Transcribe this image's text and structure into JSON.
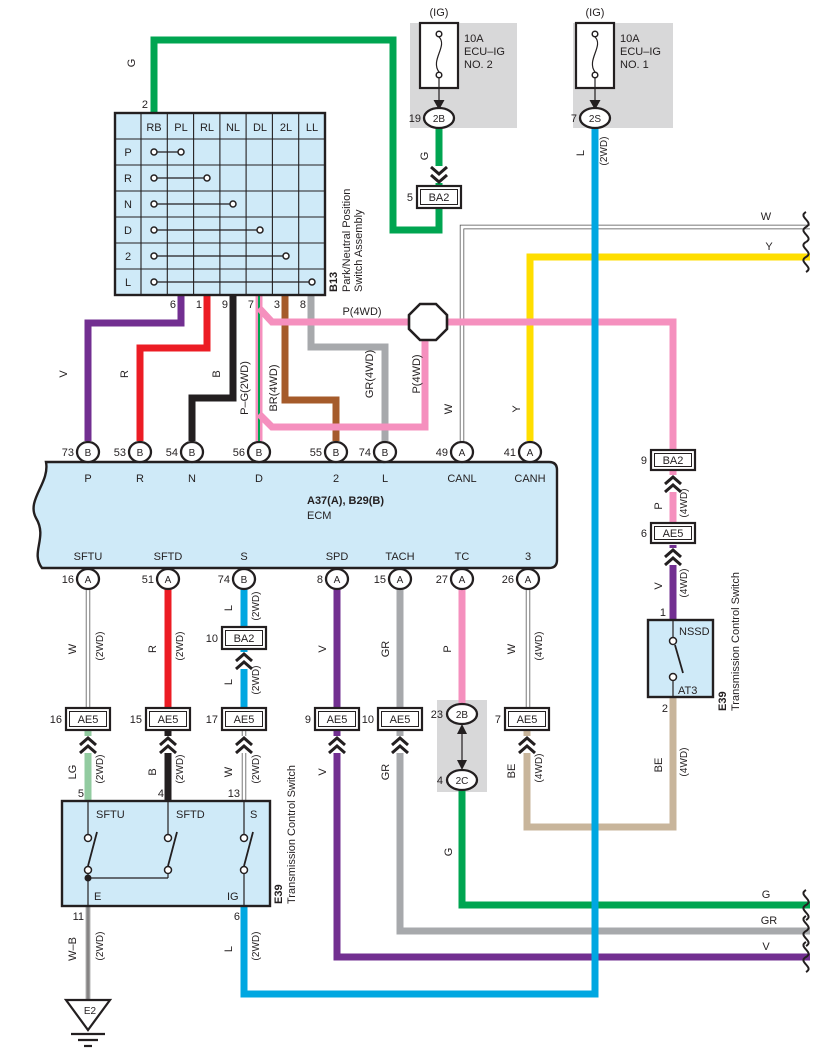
{
  "colors": {
    "green": "#00A551",
    "red": "#EC1C24",
    "black": "#231F20",
    "purple": "#722F91",
    "pink": "#F590BE",
    "brown": "#A55B2B",
    "gray": "#A7A9AC",
    "yellow": "#FFDE00",
    "cyan": "#00A7E1",
    "light_green": "#92CBA0",
    "beige": "#C8B59B",
    "component_fill": "#CFEAF8",
    "panel_gray": "#D8D8D9",
    "white_wire": "#FFFFFF"
  },
  "fuses": [
    {
      "tag": "(IG)",
      "amp": "10A",
      "name": "ECU–IG",
      "num": "NO. 2",
      "pin": "19",
      "conn": "2B"
    },
    {
      "tag": "(IG)",
      "amp": "10A",
      "name": "ECU–IG",
      "num": "NO. 1",
      "pin": "7",
      "conn": "2S"
    }
  ],
  "fuse_wires": {
    "g": "G",
    "l": "L",
    "l_sub": "(2WD)"
  },
  "pnp": {
    "code": "B13",
    "name_line1": "Park/Neutral Position",
    "name_line2": "Switch Assembly",
    "top_pin": "2",
    "top_wire": "G",
    "cols": [
      "RB",
      "PL",
      "RL",
      "NL",
      "DL",
      "2L",
      "LL"
    ],
    "rows": [
      "P",
      "R",
      "N",
      "D",
      "2",
      "L"
    ],
    "pins": [
      "6",
      "1",
      "9",
      "7",
      "3",
      "8"
    ]
  },
  "feeds": {
    "v": "V",
    "r": "R",
    "b": "B",
    "pg": "P–G(2WD)",
    "br": "BR(4WD)",
    "gr": "GR(4WD)",
    "p4h": "P(4WD)",
    "p4v": "P(4WD)",
    "w": "W",
    "y": "Y"
  },
  "ecm": {
    "code": "A37(A), B29(B)",
    "name": "ECM",
    "top": [
      {
        "n": "73",
        "c": "B",
        "l": "P"
      },
      {
        "n": "53",
        "c": "B",
        "l": "R"
      },
      {
        "n": "54",
        "c": "B",
        "l": "N"
      },
      {
        "n": "56",
        "c": "B",
        "l": "D"
      },
      {
        "n": "55",
        "c": "B",
        "l": "2"
      },
      {
        "n": "74",
        "c": "B",
        "l": "L"
      },
      {
        "n": "49",
        "c": "A",
        "l": "CANL"
      },
      {
        "n": "41",
        "c": "A",
        "l": "CANH"
      }
    ],
    "bottom": [
      {
        "n": "16",
        "c": "A",
        "l": "SFTU"
      },
      {
        "n": "51",
        "c": "A",
        "l": "SFTD"
      },
      {
        "n": "74",
        "c": "B",
        "l": "S"
      },
      {
        "n": "8",
        "c": "A",
        "l": "SPD"
      },
      {
        "n": "15",
        "c": "A",
        "l": "TACH"
      },
      {
        "n": "27",
        "c": "A",
        "l": "TC"
      },
      {
        "n": "26",
        "c": "A",
        "l": "3"
      }
    ]
  },
  "conn": {
    "ba2_top": {
      "n": "5",
      "l": "BA2"
    },
    "ba2_mid": {
      "n": "10",
      "l": "BA2"
    },
    "ba2_right": {
      "n": "9",
      "l": "BA2"
    },
    "ae5_right": {
      "n": "6",
      "l": "AE5"
    },
    "row": [
      {
        "n": "16",
        "l": "AE5"
      },
      {
        "n": "15",
        "l": "AE5"
      },
      {
        "n": "17",
        "l": "AE5"
      },
      {
        "n": "9",
        "l": "AE5"
      },
      {
        "n": "10",
        "l": "AE5"
      },
      {
        "n": "7",
        "l": "AE5"
      }
    ],
    "j2b": {
      "n": "23",
      "l": "2B"
    },
    "j2c": {
      "n": "4",
      "l": "2C"
    }
  },
  "runs": {
    "sftu_u": {
      "m": "W",
      "s": "(2WD)"
    },
    "sftd_u": {
      "m": "R",
      "s": "(2WD)"
    },
    "s_u": {
      "m": "L",
      "s": "(2WD)"
    },
    "s_m": {
      "m": "L",
      "s": "(2WD)"
    },
    "spd": {
      "m": "V"
    },
    "tach": {
      "m": "GR"
    },
    "tc": {
      "m": "P"
    },
    "p3_u": {
      "m": "W",
      "s": "(4WD)"
    },
    "sftu_l": {
      "m": "LG",
      "s": "(2WD)"
    },
    "sftd_l": {
      "m": "B",
      "s": "(2WD)"
    },
    "s_l": {
      "m": "W",
      "s": "(2WD)"
    },
    "spd_l": {
      "m": "V"
    },
    "tach_l": {
      "m": "GR"
    },
    "p3_l": {
      "m": "BE",
      "s": "(4WD)"
    },
    "wb": {
      "m": "W–B",
      "s": "(2WD)"
    },
    "l_bot": {
      "m": "L",
      "s": "(2WD)"
    },
    "g_bot": {
      "m": "G"
    },
    "right_p": {
      "m": "P",
      "s": "(4WD)"
    },
    "right_v": {
      "m": "V",
      "s": "(4WD)"
    },
    "right_be": {
      "m": "BE",
      "s": "(4WD)"
    }
  },
  "tcs": {
    "code": "E39",
    "name": "Transmission Control Switch",
    "pins_top": [
      "5",
      "4",
      "13"
    ],
    "contacts": [
      "SFTU",
      "SFTD",
      "S"
    ],
    "pins_bottom": [
      "11",
      "6"
    ],
    "bottom_contacts": [
      "E",
      "IG"
    ]
  },
  "nssd": {
    "code": "E39",
    "name": "Transmission Control Switch",
    "top": "NSSD",
    "bottom": "AT3",
    "pin_top": "1",
    "pin_bottom": "2"
  },
  "ground": {
    "code": "E2"
  },
  "edges": {
    "w": "W",
    "y": "Y",
    "g": "G",
    "gr": "GR",
    "v": "V"
  }
}
